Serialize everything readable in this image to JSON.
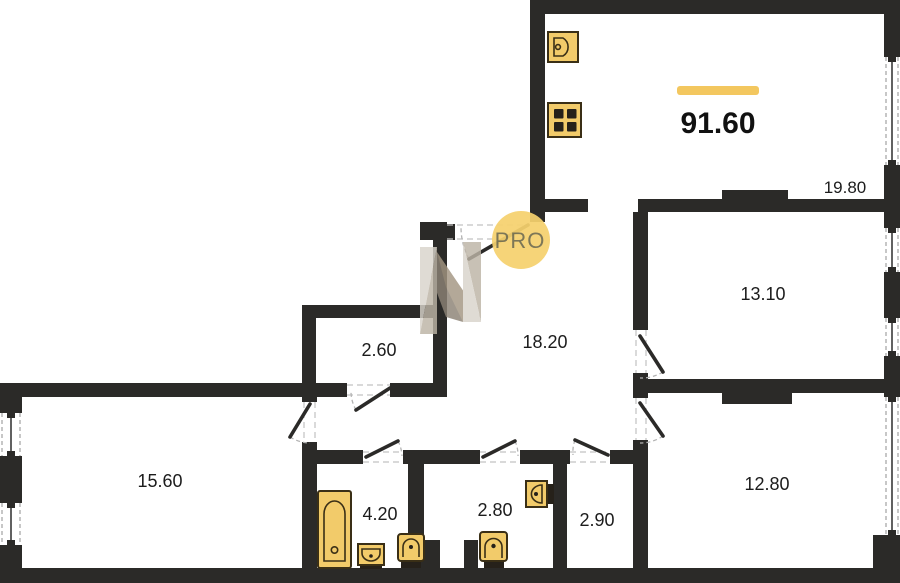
{
  "plan": {
    "title": "apartment-floor-plan",
    "total_area": {
      "value": "91.60"
    },
    "rooms": [
      {
        "id": "kitchen-living",
        "area": "19.80"
      },
      {
        "id": "bedroom-right",
        "area": "13.10"
      },
      {
        "id": "hallway",
        "area": "18.20"
      },
      {
        "id": "closet",
        "area": "2.60"
      },
      {
        "id": "bedroom-left",
        "area": "15.60"
      },
      {
        "id": "bathroom",
        "area": "4.20"
      },
      {
        "id": "wc",
        "area": "2.80"
      },
      {
        "id": "storage",
        "area": "2.90"
      },
      {
        "id": "bedroom-bottom",
        "area": "12.80"
      }
    ],
    "watermark": {
      "label": "PRO"
    },
    "fixtures": [
      "kitchen-sink-icon",
      "stove-icon",
      "bathtub-icon",
      "bath-sink-icon",
      "toilet-icon",
      "toilet-icon",
      "wall-sink-icon"
    ],
    "colors": {
      "wall": "#2b2a28",
      "accent_yellow": "#F3C75F",
      "fixture_fill": "#F2CB6A",
      "fixture_stroke": "#3a2f16",
      "watermark_circle": "#F5D16E",
      "watermark_text": "#60604f",
      "logo_light": "#d9d4cb",
      "logo_mid": "#bdb4a6",
      "logo_dark": "#8c8275",
      "logo_brown": "#a39682"
    }
  }
}
